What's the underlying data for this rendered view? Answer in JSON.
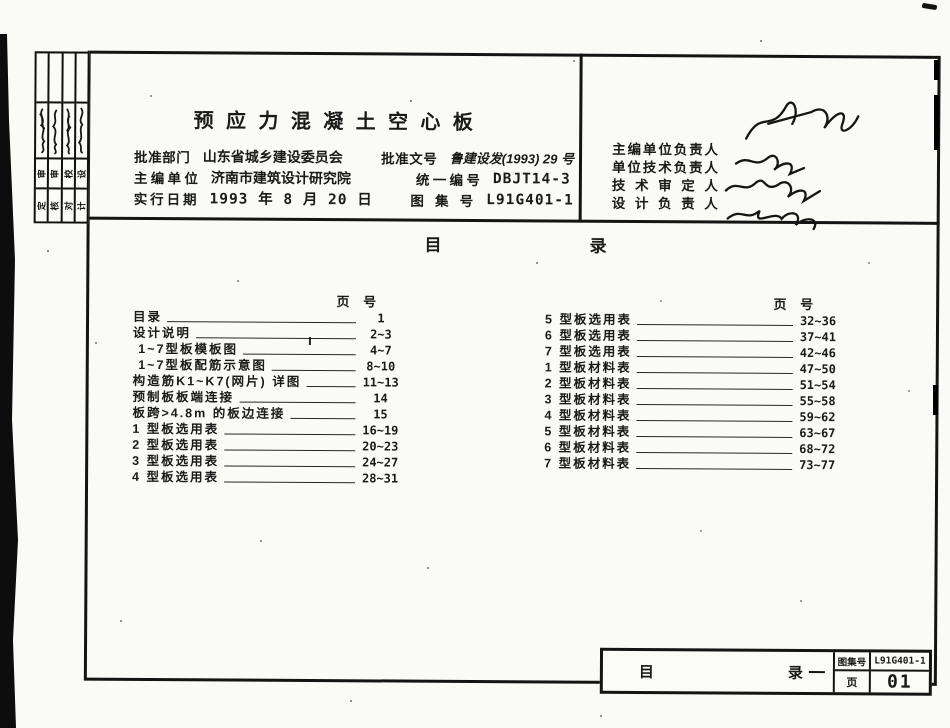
{
  "page": {
    "bg": "#fafaf6",
    "ink": "#1a1a1a"
  },
  "title_block": {
    "title": "预应力混凝土空心板",
    "rows": [
      {
        "label": "批准部门",
        "value": "山东省城乡建设委员会",
        "label2": "批准文号",
        "value2": "鲁建设发(1993) 29 号"
      },
      {
        "label": "主编单位",
        "value": "济南市建筑设计研究院",
        "label2": "统一编号",
        "value2": "DBJT14-3"
      },
      {
        "label": "实行日期",
        "value": "1993 年 8 月 20 日",
        "label2": "图集号",
        "value2": "L91G401-1"
      }
    ]
  },
  "signature_block": {
    "labels": [
      "主编单位负责人",
      "单位技术负责人",
      "技术审定人",
      "设计负责人"
    ]
  },
  "toc": {
    "heading": [
      "目",
      "录"
    ],
    "page_col_header": "页 号",
    "left": [
      {
        "label": "目录",
        "pages": "1"
      },
      {
        "label": "设计说明",
        "pages": "2~3"
      },
      {
        "label": " 1~7型板模板图",
        "pages": "4~7"
      },
      {
        "label": " 1~7型板配筋示意图",
        "pages": "8~10"
      },
      {
        "label": "构造筋K1~K7(网片) 详图",
        "pages": "11~13"
      },
      {
        "label": "预制板板端连接",
        "pages": "14"
      },
      {
        "label": "板跨>4.8m 的板边连接",
        "pages": "15"
      },
      {
        "label": "1 型板选用表",
        "pages": "16~19"
      },
      {
        "label": "2 型板选用表",
        "pages": "20~23"
      },
      {
        "label": "3 型板选用表",
        "pages": "24~27"
      },
      {
        "label": "4 型板选用表",
        "pages": "28~31"
      }
    ],
    "right": [
      {
        "label": "5 型板选用表",
        "pages": "32~36"
      },
      {
        "label": "6 型板选用表",
        "pages": "37~41"
      },
      {
        "label": "7 型板选用表",
        "pages": "42~46"
      },
      {
        "label": "1 型板材料表",
        "pages": "47~50"
      },
      {
        "label": "2 型板材料表",
        "pages": "51~54"
      },
      {
        "label": "3 型板材料表",
        "pages": "55~58"
      },
      {
        "label": "4 型板材料表",
        "pages": "59~62"
      },
      {
        "label": "5 型板材料表",
        "pages": "63~67"
      },
      {
        "label": "6 型板材料表",
        "pages": "68~72"
      },
      {
        "label": "7 型板材料表",
        "pages": "73~77"
      }
    ]
  },
  "footer_block": {
    "sheet_title_left": "目",
    "sheet_title_right": "录",
    "atlas_label": "图集号",
    "atlas_no": "L91G401-1",
    "page_label": "页",
    "page_no": "01"
  },
  "edge_strip": {
    "columns": [
      {
        "upper": "审",
        "lower": "定"
      },
      {
        "upper": "审",
        "lower": "核"
      },
      {
        "upper": "校",
        "lower": "对"
      },
      {
        "upper": "设",
        "lower": "计"
      }
    ]
  }
}
